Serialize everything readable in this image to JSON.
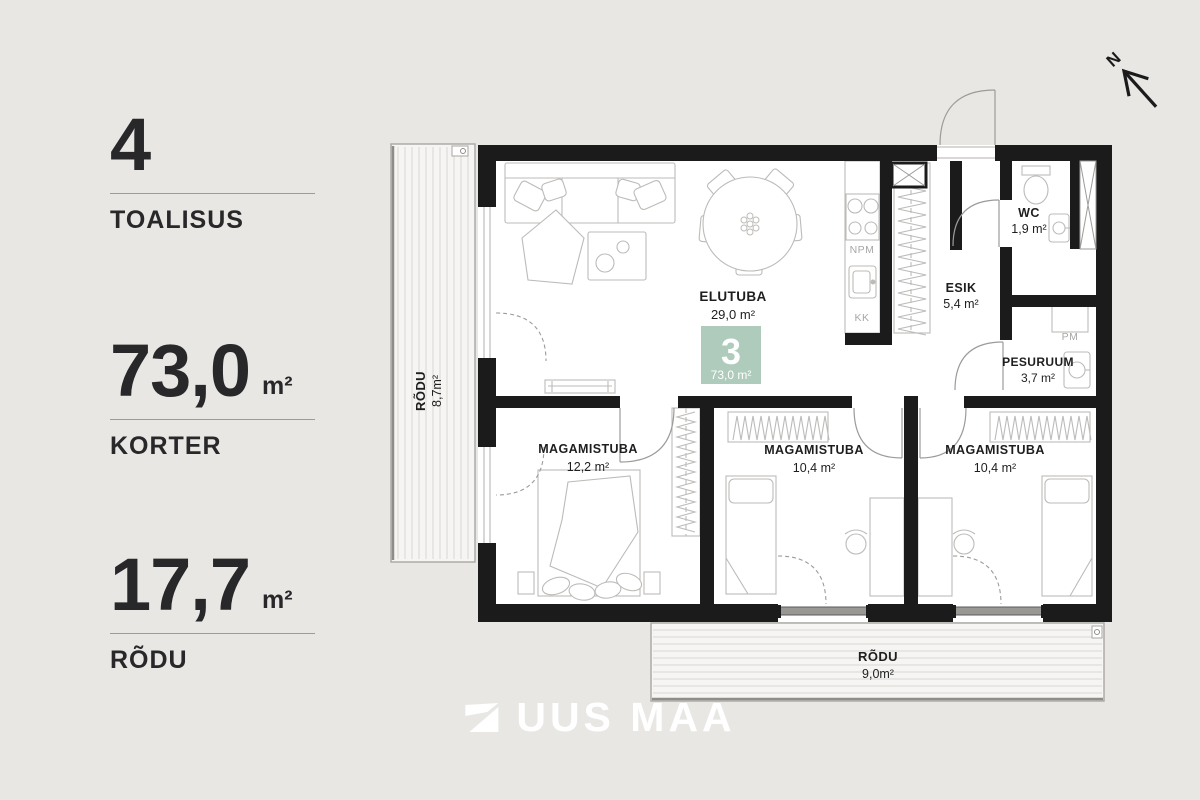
{
  "sidebar": {
    "blocks": [
      {
        "value": "4",
        "unit": "",
        "label": "TOALISUS"
      },
      {
        "value": "73,0",
        "unit": "m²",
        "label": "KORTER"
      },
      {
        "value": "17,7",
        "unit": "m²",
        "label": "RÕDU"
      }
    ]
  },
  "plan": {
    "badge": {
      "number": "3",
      "area": "73,0 m²",
      "color": "#aecbbc"
    },
    "rooms": {
      "elutuba": {
        "name": "ELUTUBA",
        "area": "29,0 m²"
      },
      "wc": {
        "name": "WC",
        "area": "1,9 m²"
      },
      "esik": {
        "name": "ESIK",
        "area": "5,4 m²"
      },
      "pesuruum": {
        "name": "PESURUUM",
        "area": "3,7 m²"
      },
      "bedroom1": {
        "name": "MAGAMISTUBA",
        "area": "12,2 m²"
      },
      "bedroom2": {
        "name": "MAGAMISTUBA",
        "area": "10,4 m²"
      },
      "bedroom3": {
        "name": "MAGAMISTUBA",
        "area": "10,4 m²"
      },
      "balcony_left": {
        "name": "RÕDU",
        "area": "8,7m²"
      },
      "balcony_bottom": {
        "name": "RÕDU",
        "area": "9,0m²"
      }
    },
    "appliances": {
      "npm": "NPM",
      "kk": "KK",
      "pm": "PM"
    },
    "compass": {
      "label": "N"
    }
  },
  "footer": {
    "brand": "UUS MAA"
  }
}
